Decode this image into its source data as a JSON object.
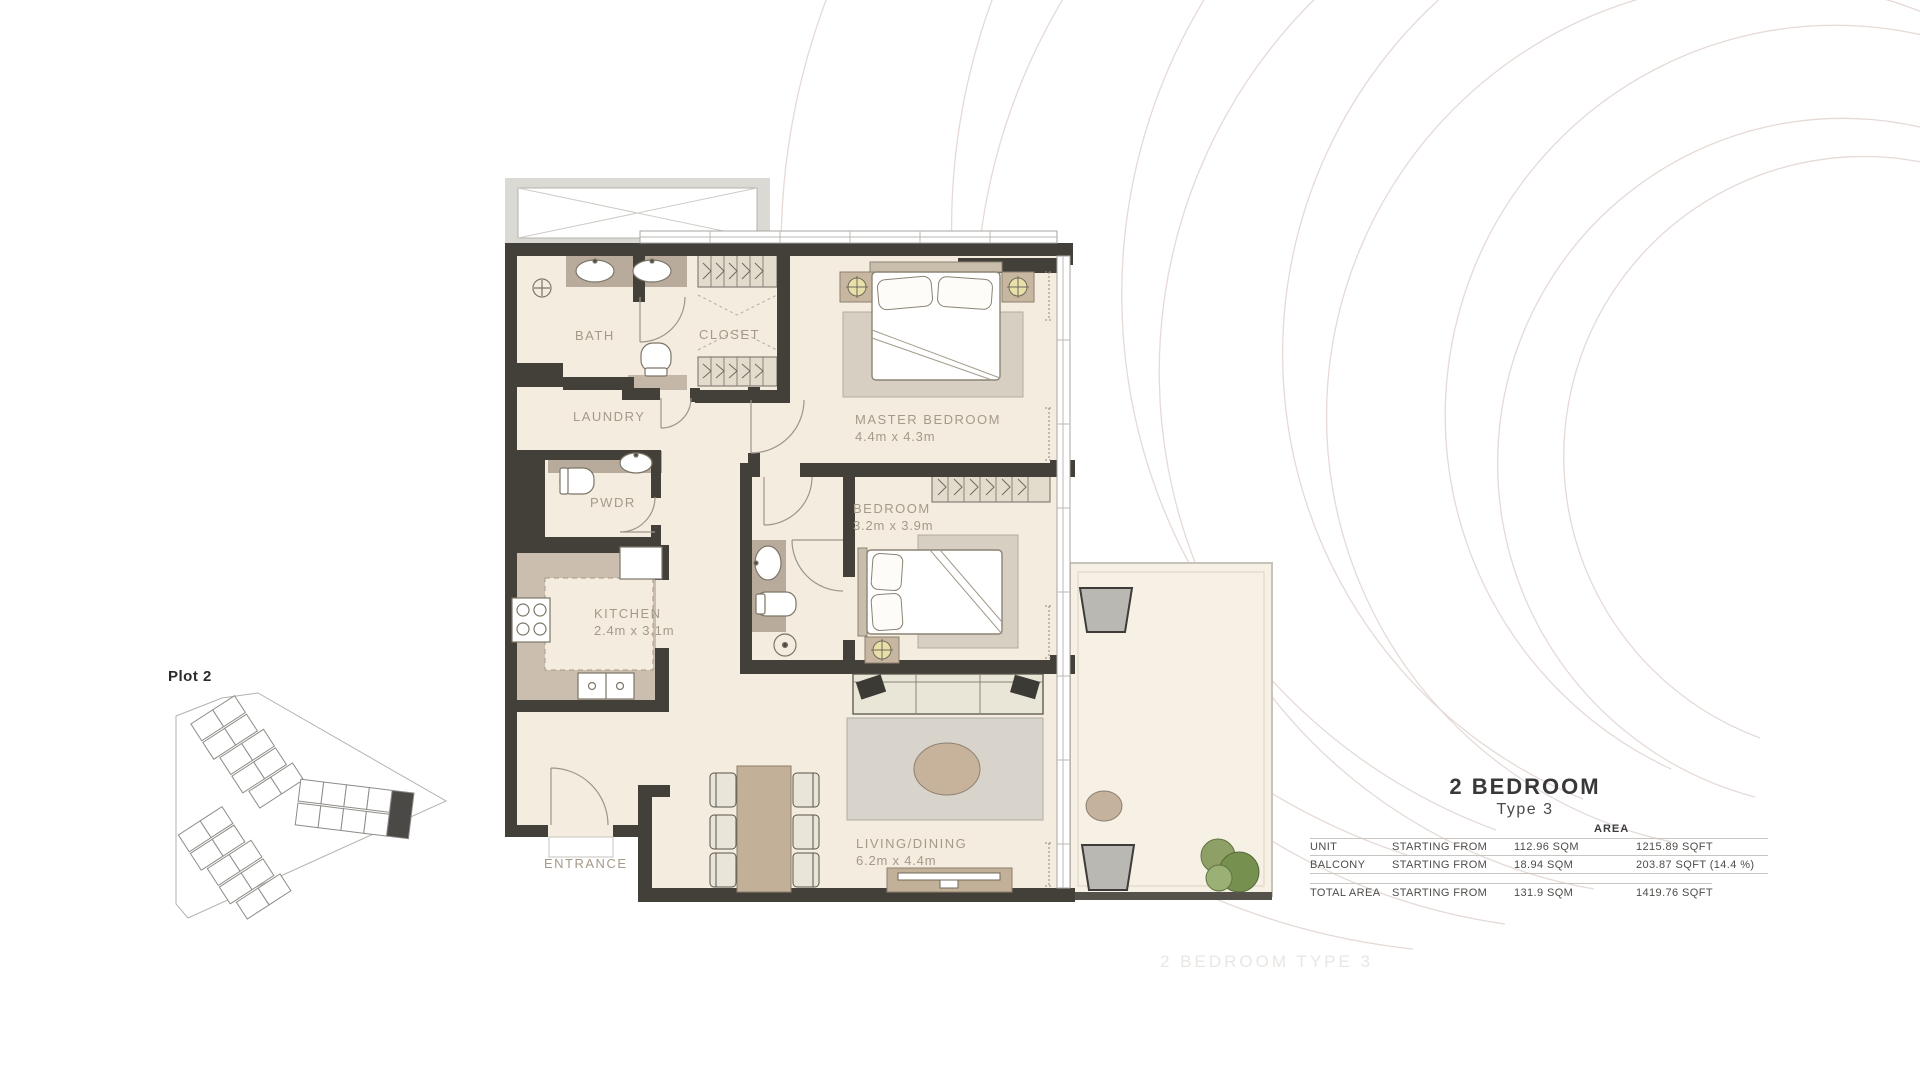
{
  "site_plan": {
    "label": "Plot 2"
  },
  "floor_plan": {
    "rooms": [
      {
        "name": "BATH",
        "dims": ""
      },
      {
        "name": "CLOSET",
        "dims": ""
      },
      {
        "name": "LAUNDRY",
        "dims": ""
      },
      {
        "name": "PWDR",
        "dims": ""
      },
      {
        "name": "KITCHEN",
        "dims": "2.4m x 3.1m"
      },
      {
        "name": "MASTER BEDROOM",
        "dims": "4.4m x 4.3m"
      },
      {
        "name": "BEDROOM",
        "dims": "3.2m x 3.9m"
      },
      {
        "name": "LIVING/DINING",
        "dims": "6.2m x 4.4m"
      },
      {
        "name": "ENTRANCE",
        "dims": ""
      }
    ]
  },
  "info": {
    "title": "2 BEDROOM",
    "subtitle": "Type 3",
    "area_header": "AREA",
    "rows": [
      {
        "label": "UNIT",
        "qualifier": "STARTING FROM",
        "sqm": "112.96 SQM",
        "sqft": "1215.89 SQFT"
      },
      {
        "label": "BALCONY",
        "qualifier": "STARTING FROM",
        "sqm": "18.94 SQM",
        "sqft": "203.87 SQFT (14.4 %)"
      },
      {
        "label": "TOTAL AREA",
        "qualifier": "STARTING FROM",
        "sqm": "131.9 SQM",
        "sqft": "1419.76  SQFT"
      }
    ]
  },
  "watermark": "2 BEDROOM TYPE 3",
  "colors": {
    "wall": "#434039",
    "floor": "#f4ecdf",
    "counter": "#b9ab9b",
    "kitchen_floor": "#cbbeae",
    "label_text": "#a59a89",
    "title_text": "#383838",
    "arc_decoration": "#e5dad6",
    "plant_green": "#7d9455"
  }
}
